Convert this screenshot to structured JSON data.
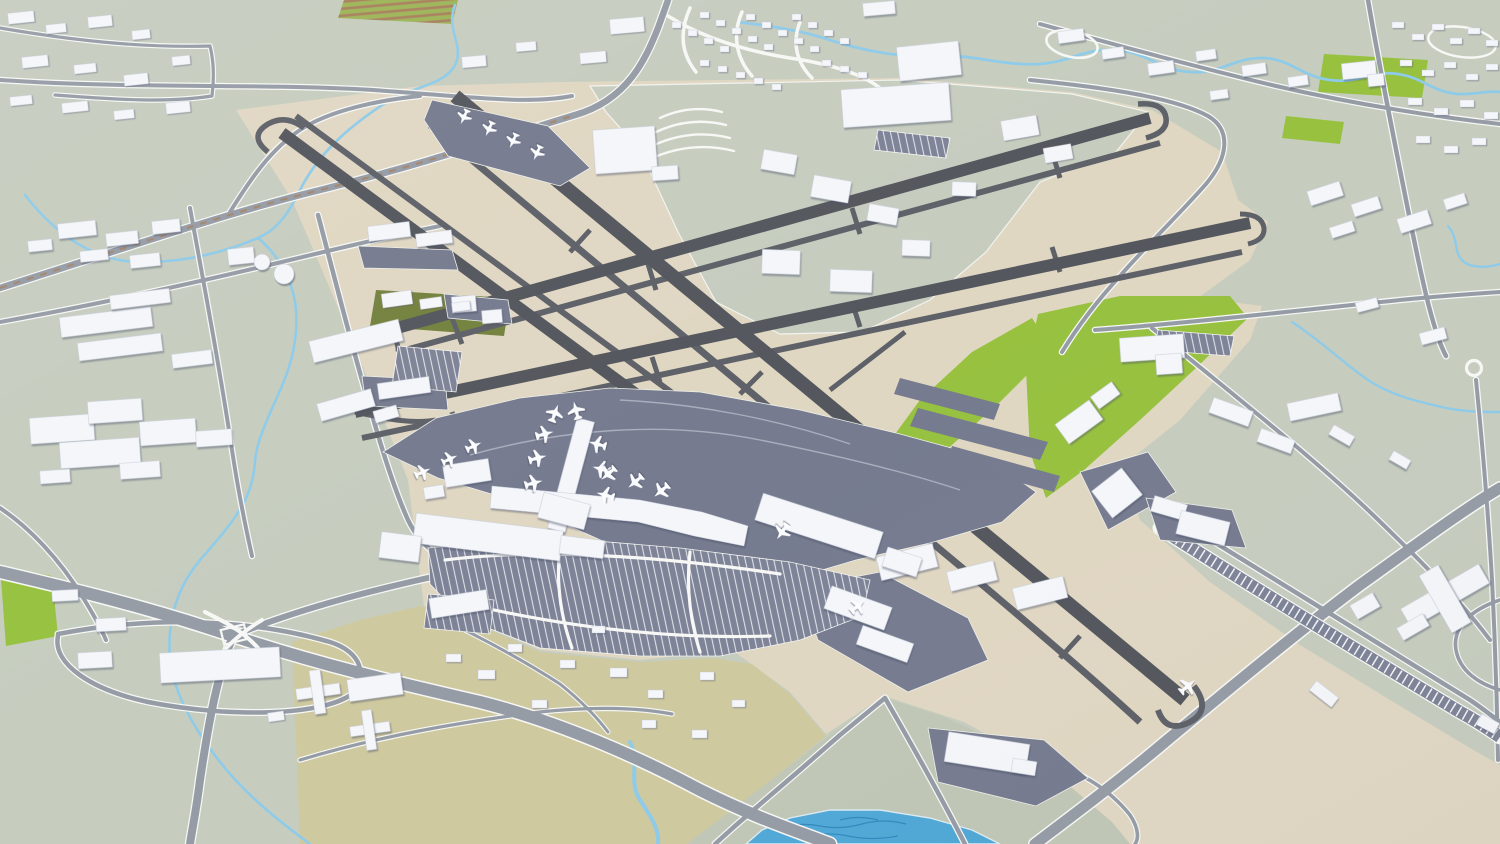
{
  "scene": {
    "description": "3D aerial low-poly render of a large international airport and the surrounding city: two pairs of crossing runways with parallel taxiways, a passenger terminal with pier concourses and docked airliners, cargo aprons, striped surface parking lots, a highway interchange, an angled parking corridor, meandering creeks, a pond, parkland parcels and scattered white buildings.",
    "style": "untextured 3D city model, soft daylight, no text labels",
    "aircraft_visible": 21,
    "runway_strips": 4,
    "features": [
      "crossing-runways",
      "parallel-taxiways",
      "terminal-pier-concourses",
      "docked-airliners",
      "cargo-aprons",
      "striped-parking-lots",
      "highway-interchange",
      "angled-parking-corridor",
      "creeks",
      "pond",
      "golf-parkland",
      "green-campus-parcels",
      "warehouse-blocks",
      "residential-subdivision",
      "fuel-tanks"
    ]
  },
  "colors": {
    "ground": "#c6cdbf",
    "lowland": "#c0c7b6",
    "airfield": "#e0d7c3",
    "golf": "#cfc9a0",
    "green": "#97c13f",
    "olive": "#74823f",
    "farm-green": "#9db457",
    "farm-brown": "#a87f5c",
    "runway": "#54575d",
    "taxiway": "#5e6168",
    "apron": "#767b8f",
    "parking": "#7e8397",
    "road": "#969ca6",
    "road-casing": "#f7f8f5",
    "water": "#8ecbe9",
    "lake": "#51a8d6",
    "lake-deep": "#2c84b8",
    "bldg": "#f4f6fa",
    "bldg-edge": "#c6cbd8",
    "plane": "#fbfcfe"
  }
}
